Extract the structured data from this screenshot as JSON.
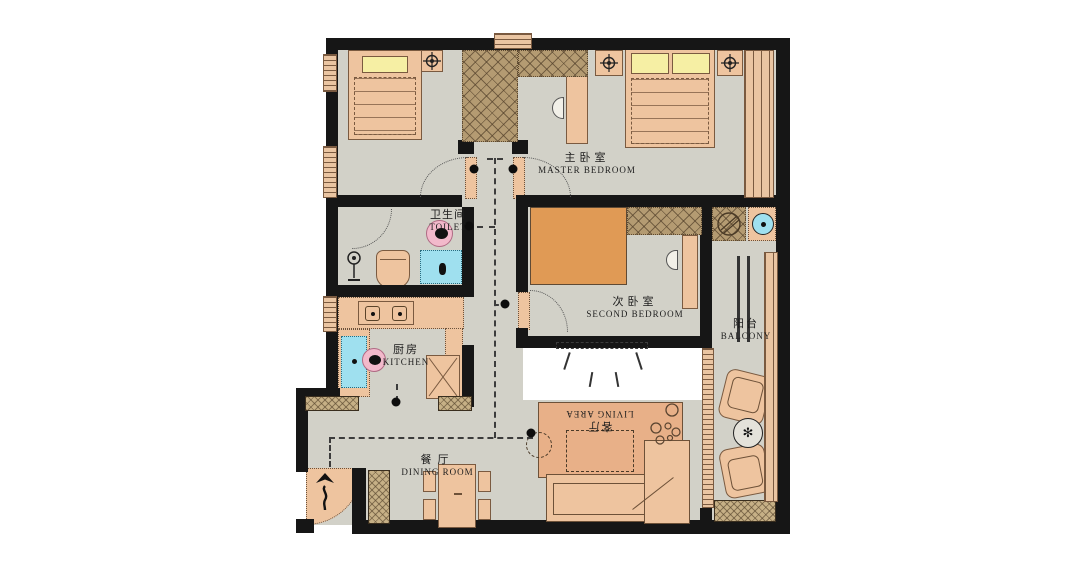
{
  "plan": {
    "rooms": {
      "master_bedroom": {
        "zh": "主卧室",
        "en": "MASTER BEDROOM"
      },
      "toilet": {
        "zh": "卫生间",
        "en": "TOILET"
      },
      "second_bedroom": {
        "zh": "次卧室",
        "en": "SECOND BEDROOM"
      },
      "balcony": {
        "zh": "阳台",
        "en": "BALCONY"
      },
      "kitchen": {
        "zh": "厨房",
        "en": "KITCHEN"
      },
      "dining_room": {
        "zh": "餐厅",
        "en": "DINING ROOM"
      },
      "living_area": {
        "zh": "客厅",
        "en": "LIVING AREA"
      }
    },
    "colors": {
      "wall": "#161616",
      "floor": "#d2d1c8",
      "furniture": "#eec49f",
      "furniture_border": "#7a5a40",
      "rug": "#e8b088",
      "tatami": "#e09a55",
      "closet": "#b49b72",
      "pillow": "#f6efa4",
      "water": "#9fe0ef",
      "pink": "#f2b9cb",
      "window": "#eac5a2"
    }
  }
}
